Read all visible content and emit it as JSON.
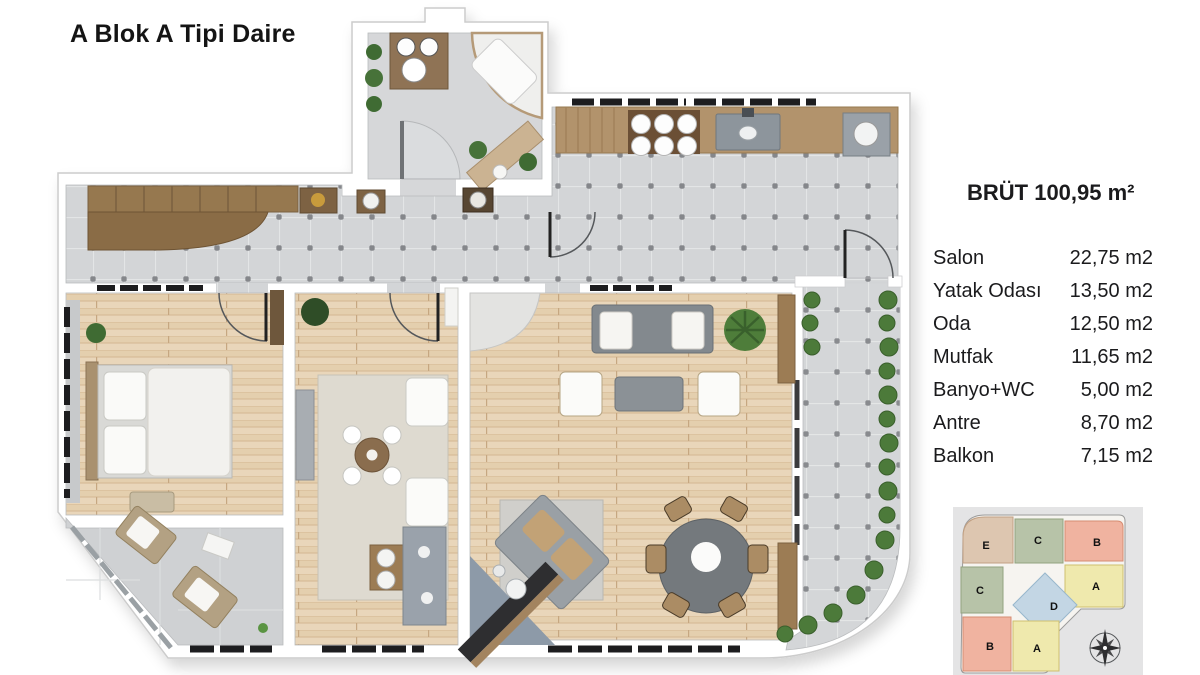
{
  "page": {
    "title": "A Blok A Tipi Daire",
    "background": "#ffffff"
  },
  "area_table": {
    "title": "BRÜT 100,95 m²",
    "rows": [
      {
        "label": "Salon",
        "value": "22,75 m2"
      },
      {
        "label": "Yatak Odası",
        "value": "13,50 m2"
      },
      {
        "label": "Oda",
        "value": "12,50 m2"
      },
      {
        "label": "Mutfak",
        "value": "11,65 m2"
      },
      {
        "label": "Banyo+WC",
        "value": "5,00 m2"
      },
      {
        "label": "Antre",
        "value": "8,70 m2"
      },
      {
        "label": "Balkon",
        "value": "7,15 m2"
      }
    ]
  },
  "keyplan": {
    "units": [
      {
        "label": "E",
        "color": "#ddc6b0"
      },
      {
        "label": "C",
        "color": "#b7c3a8"
      },
      {
        "label": "B",
        "color": "#f0b3a0"
      },
      {
        "label": "C",
        "color": "#b7c3a8"
      },
      {
        "label": "A",
        "color": "#efe9ad"
      },
      {
        "label": "D",
        "color": "#c3d6e4"
      },
      {
        "label": "B",
        "color": "#f0b3a0"
      },
      {
        "label": "A",
        "color": "#efe9ad"
      }
    ],
    "background": "#e4e4e5"
  },
  "colors": {
    "wall": "#ffffff",
    "tile_floor": "#d3d5d7",
    "wood_floor": "#e9d6ba",
    "plant_green": "#4c7a3a",
    "text": "#1b1b1d"
  }
}
